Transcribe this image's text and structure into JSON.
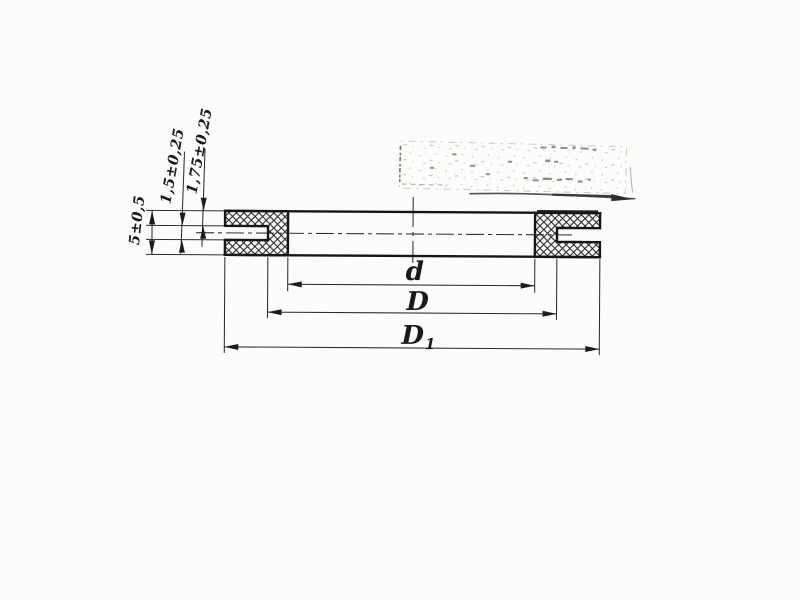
{
  "dimension_labels": {
    "thickness": "5±0,5",
    "groove_width": "1,5±0,25",
    "lip_thickness": "1,75±0,25",
    "inner_diameter": "d",
    "mid_diameter": "D",
    "outer_diameter_base": "D",
    "outer_diameter_subscript": "1"
  },
  "colors": {
    "ink": "#1a1a1a",
    "paper": "#fcfcfb",
    "stamp_faded": "#b3b1a9",
    "stamp_smudge": "#3d3b37"
  }
}
